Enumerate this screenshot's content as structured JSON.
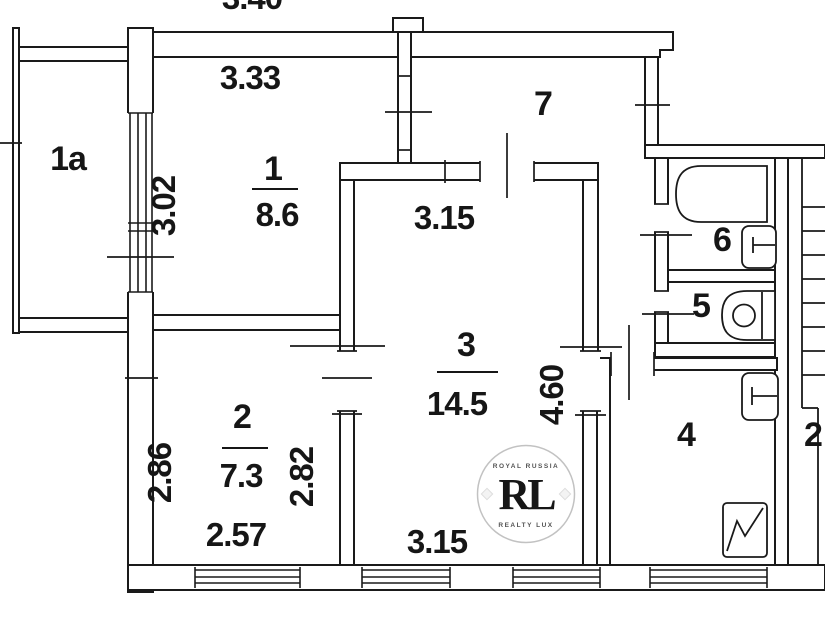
{
  "plan": {
    "rooms": {
      "balcony": {
        "label": "1a"
      },
      "room1": {
        "label": "1",
        "area": "8.6",
        "width_top": "3.33",
        "height_left": "3.02"
      },
      "room2": {
        "label": "2",
        "area": "7.3",
        "height_left": "2.86",
        "height_right": "2.82",
        "width_bottom": "2.57"
      },
      "room3": {
        "label": "3",
        "area": "14.5",
        "width_top": "3.15",
        "width_bottom": "3.15",
        "height_right": "4.60"
      },
      "room4": {
        "label": "4"
      },
      "room5": {
        "label": "5"
      },
      "room6": {
        "label": "6"
      },
      "room7": {
        "label": "7"
      },
      "adjacent": {
        "label": "2"
      }
    },
    "top_edge_dimension_partial": "3.40",
    "fixtures": [
      "bathtub",
      "washbasin",
      "toilet",
      "kitchen-sink",
      "stove"
    ],
    "watermark": {
      "monogram": "RL",
      "arc_top": "ROYAL RUSSIA",
      "arc_bottom": "REALTY LUX"
    },
    "colors": {
      "line": "#1a1a1a",
      "watermark_gold": "#c3a13d"
    }
  }
}
